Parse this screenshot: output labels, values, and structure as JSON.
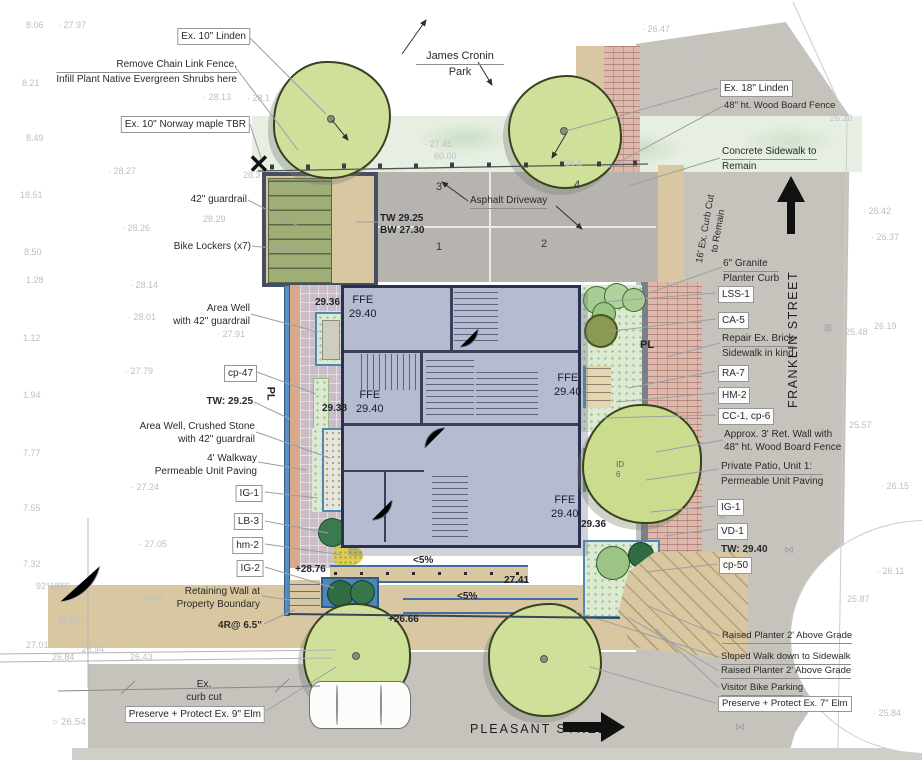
{
  "park": {
    "line1": "James Cronin",
    "line2": "Park"
  },
  "streets": {
    "franklin": "FRANKLIN STREET",
    "pleasant": "PLEASANT STREET"
  },
  "labels_left": {
    "ex10_linden": "Ex. 10\" Linden",
    "remove_fence_1": "Remove Chain Link Fence,",
    "remove_fence_2": "Infill Plant Native Evergreen Shrubs here",
    "norway_maple": "Ex. 10\" Norway maple TBR",
    "guardrail_42": "42\" guardrail",
    "bike_lockers": "Bike Lockers (x7)",
    "area_well_1_1": "Area Well",
    "area_well_1_2": "with 42\" guardrail",
    "cp_47": "cp-47",
    "tw_2925": "TW: 29.25",
    "area_well_2_1": "Area Well, Crushed Stone",
    "area_well_2_2": "with 42\" guardrail",
    "walkway_1": "4' Walkway",
    "walkway_2": "Permeable Unit Paving",
    "ig_1": "IG-1",
    "lb_3": "LB-3",
    "hm_2": "hm-2",
    "ig_2": "IG-2",
    "retaining_1": "Retaining Wall at",
    "retaining_2": "Property Boundary",
    "risers": "4R@ 6.5\"",
    "ex_curb_1": "Ex.",
    "ex_curb_2": "curb cut",
    "preserve_9_elm": "Preserve + Protect Ex. 9\" Elm"
  },
  "labels_right": {
    "ex18_linden": "Ex. 18\" Linden",
    "wood_fence": "48\" ht. Wood Board Fence",
    "concrete_1": "Concrete Sidewalk to",
    "concrete_2": "Remain",
    "curb_cut_16_1": "16' Ex. Curb Cut",
    "curb_cut_16_2": "to Remain",
    "granite_1": "6\" Granite",
    "granite_2": "Planter Curb",
    "lss_1": "LSS-1",
    "ca_5": "CA-5",
    "repair_1": "Repair Ex. Brick",
    "repair_2": "Sidewalk in kind",
    "ra_7": "RA-7",
    "hm_2": "HM-2",
    "cc_1": "CC-1, cp-6",
    "ret_wall_1": "Approx. 3' Ret. Wall with",
    "ret_wall_2": "48\" ht. Wood Board Fence",
    "patio_1": "Private Patio, Unit 1:",
    "patio_2": "Permeable Unit Paving",
    "ig_1": "IG-1",
    "vd_1": "VD-1",
    "tw_2940": "TW: 29.40",
    "cp_50": "cp-50",
    "raised_planter_1": "Raised Planter 2' Above Grade",
    "sloped_walk": "Sloped Walk down to Sidewalk",
    "raised_planter_2": "Raised Planter 2' Above Grade",
    "visitor_bike": "Visitor Bike Parking",
    "preserve_7_elm": "Preserve + Protect Ex. 7\" Elm"
  },
  "driveway": {
    "label": "Asphalt Driveway",
    "stalls": [
      "1",
      "2",
      "3",
      "4"
    ],
    "tw": "TW 29.25",
    "bw": "BW 27.30"
  },
  "building": {
    "ffe": "FFE",
    "elev": "29.40"
  },
  "spots": {
    "e2936_nw": "29.36",
    "e2938": "29.38",
    "e2936_se": "29.36",
    "e2876": "+28.76",
    "e2741": "27.41",
    "e2666": "+26.66",
    "slope_a": "<5%",
    "slope_b": "<5%"
  },
  "misc": {
    "pl_east": "PL",
    "pl_west": "PL",
    "patio_id_1": "ID",
    "patio_id_2": "6"
  },
  "icons": {
    "tree_removal_x": "✕",
    "water_valve": "⋈",
    "survey_grate": "⊞",
    "benchmark_circle": "○ 26.54"
  },
  "survey_points": [
    {
      "v": "8.06",
      "x": 26,
      "y": 20
    },
    {
      "v": "· 27.97",
      "x": 58,
      "y": 20
    },
    {
      "v": "8.21",
      "x": 22,
      "y": 78
    },
    {
      "v": "· 28.13",
      "x": 203,
      "y": 92
    },
    {
      "v": "· 28.1",
      "x": 247,
      "y": 93
    },
    {
      "v": "8.49",
      "x": 26,
      "y": 133
    },
    {
      "v": "· 28.27",
      "x": 108,
      "y": 166
    },
    {
      "v": "28.3",
      "x": 243,
      "y": 170
    },
    {
      "v": "18.51",
      "x": 20,
      "y": 190
    },
    {
      "v": "28.29",
      "x": 203,
      "y": 214
    },
    {
      "v": "· 28.26",
      "x": 122,
      "y": 223
    },
    {
      "v": "8.50",
      "x": 24,
      "y": 247
    },
    {
      "v": "1.28",
      "x": 26,
      "y": 275
    },
    {
      "v": "· 28.14",
      "x": 130,
      "y": 280
    },
    {
      "v": "· 28.01",
      "x": 128,
      "y": 312
    },
    {
      "v": "· 27.91",
      "x": 217,
      "y": 329
    },
    {
      "v": "1.12",
      "x": 23,
      "y": 333
    },
    {
      "v": "· 27.79",
      "x": 125,
      "y": 366
    },
    {
      "v": "1.94",
      "x": 23,
      "y": 390
    },
    {
      "v": "7.77",
      "x": 23,
      "y": 448
    },
    {
      "v": "· 27.24",
      "x": 131,
      "y": 482
    },
    {
      "v": "7.55",
      "x": 23,
      "y": 503
    },
    {
      "v": "· 27.05",
      "x": 139,
      "y": 539
    },
    {
      "v": "7.32",
      "x": 23,
      "y": 559
    },
    {
      "v": "92°18'0\"",
      "x": 36,
      "y": 581
    },
    {
      "v": "· 26.98",
      "x": 135,
      "y": 593
    },
    {
      "v": "26.96",
      "x": 58,
      "y": 615
    },
    {
      "v": "27.01",
      "x": 26,
      "y": 640
    },
    {
      "v": "· 26.94",
      "x": 76,
      "y": 644
    },
    {
      "v": "26.84",
      "x": 52,
      "y": 652
    },
    {
      "v": "26.43",
      "x": 130,
      "y": 652
    },
    {
      "v": "· 27.45",
      "x": 424,
      "y": 139
    },
    {
      "v": "60.00",
      "x": 434,
      "y": 151
    },
    {
      "v": "26.5",
      "x": 565,
      "y": 158
    },
    {
      "v": "· 26.47",
      "x": 642,
      "y": 24
    },
    {
      "v": "26.46",
      "x": 680,
      "y": 43
    },
    {
      "v": "26.20",
      "x": 830,
      "y": 113
    },
    {
      "v": "· 26.42",
      "x": 863,
      "y": 206
    },
    {
      "v": "· 26.37",
      "x": 871,
      "y": 232
    },
    {
      "v": "26.19",
      "x": 874,
      "y": 321
    },
    {
      "v": "25.48",
      "x": 845,
      "y": 327
    },
    {
      "v": "25.57",
      "x": 849,
      "y": 420
    },
    {
      "v": "· 26.15",
      "x": 881,
      "y": 481
    },
    {
      "v": "· 26.11",
      "x": 877,
      "y": 566
    },
    {
      "v": "25.87",
      "x": 847,
      "y": 594
    },
    {
      "v": "· 25.84",
      "x": 873,
      "y": 708
    }
  ],
  "colors": {
    "building": "#b5bcd0",
    "tree_canopy": "#cfe09b",
    "site_blue": "#4f86b8",
    "brick_sidewalk": "#ddb9ad",
    "concrete": "#c6c3bd",
    "paving_tan": "#d8c7a0",
    "walkway_purple": "#cabdc7",
    "locker_green": "#9fae77"
  }
}
